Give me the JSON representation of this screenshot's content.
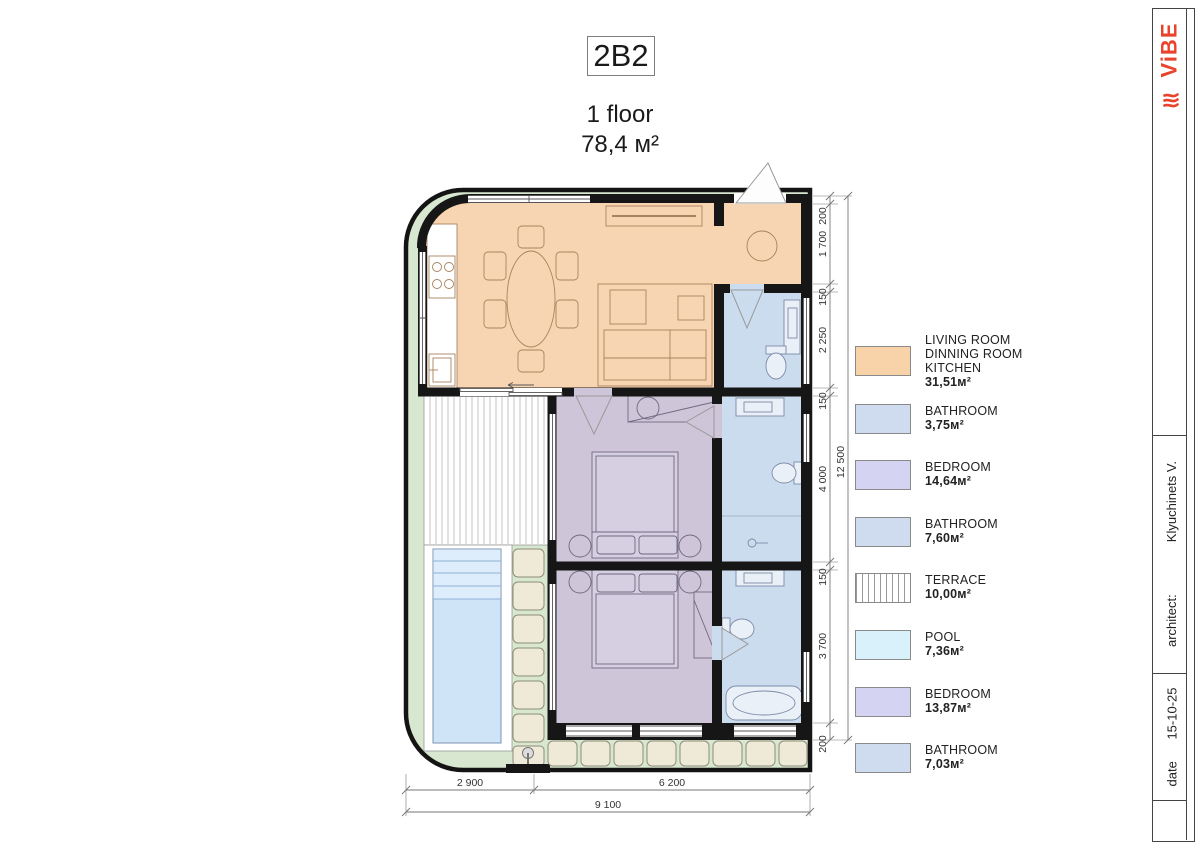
{
  "header": {
    "unit_code": "2B2",
    "floor": "1 floor",
    "total_area": "78,4 м²"
  },
  "legend": {
    "items": [
      {
        "name_lines": [
          "LIVING ROOM",
          "DINNING ROOM",
          "KITCHEN"
        ],
        "area": "31,51м²",
        "color": "#f8d2a9",
        "hatch": false
      },
      {
        "name_lines": [
          "BATHROOM"
        ],
        "area": "3,75м²",
        "color": "#cfdcf0",
        "hatch": false
      },
      {
        "name_lines": [
          "BEDROOM"
        ],
        "area": "14,64м²",
        "color": "#d5d3f2",
        "hatch": false
      },
      {
        "name_lines": [
          "BATHROOM"
        ],
        "area": "7,60м²",
        "color": "#cfdcf0",
        "hatch": false
      },
      {
        "name_lines": [
          "TERRACE"
        ],
        "area": "10,00м²",
        "color": "#ffffff",
        "hatch": true
      },
      {
        "name_lines": [
          "POOL"
        ],
        "area": "7,36м²",
        "color": "#d9f1fb",
        "hatch": false
      },
      {
        "name_lines": [
          "BEDROOM"
        ],
        "area": "13,87м²",
        "color": "#d5d3f2",
        "hatch": false
      },
      {
        "name_lines": [
          "BATHROOM"
        ],
        "area": "7,03м²",
        "color": "#cfdcf0",
        "hatch": false
      }
    ]
  },
  "dimensions": {
    "right_segments": [
      "200",
      "1 700",
      "150",
      "2 250",
      "150",
      "4 000",
      "150",
      "3 700",
      "200"
    ],
    "right_total": "12 500",
    "bottom_segments": [
      "2 900",
      "6 200"
    ],
    "bottom_total": "9 100"
  },
  "titleblock": {
    "logo": "ViBE",
    "architect_label": "architect:",
    "architect_value": "Klyuchinets V.",
    "date_label": "date",
    "date_value": "15-10-25"
  },
  "plan_colors": {
    "living": "#f8d5b2",
    "bathroom": "#ccdcef",
    "bedroom": "#cfc5d9",
    "pool": "#cfe4f7",
    "lawn": "#d8e7cf",
    "stone": "#efead8",
    "wall": "#161616"
  }
}
